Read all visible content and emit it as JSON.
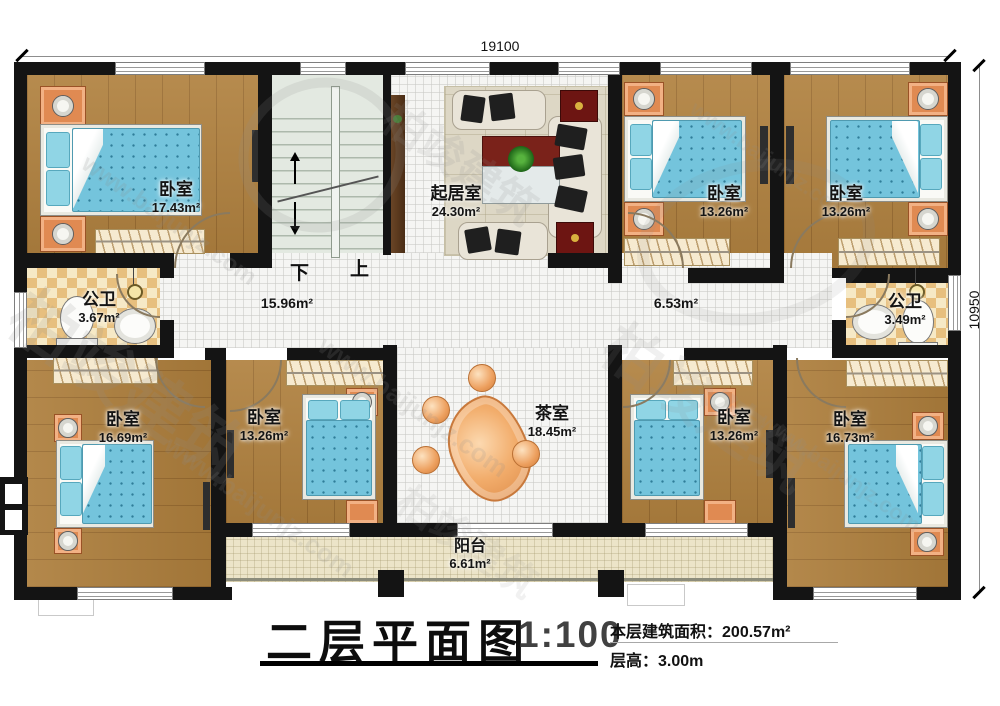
{
  "watermark": {
    "brand": "柏竣建筑",
    "site": "www.baijunjz.com"
  },
  "dimensions": {
    "top": "19100",
    "right": "10950"
  },
  "plan": {
    "stairs_down": "下",
    "stairs_up": "上",
    "hall_left_area": "15.96m²",
    "hall_right_area": "6.53m²"
  },
  "rooms": {
    "bedroom_tl": {
      "name": "卧室",
      "area": "17.43m²"
    },
    "bedroom_t2": {
      "name": "卧室",
      "area": "13.26m²"
    },
    "bedroom_t3": {
      "name": "卧室",
      "area": "13.26m²"
    },
    "living": {
      "name": "起居室",
      "area": "24.30m²"
    },
    "bath_left": {
      "name": "公卫",
      "area": "3.67m²"
    },
    "bath_right": {
      "name": "公卫",
      "area": "3.49m²"
    },
    "bedroom_bl": {
      "name": "卧室",
      "area": "16.69m²"
    },
    "bedroom_b2": {
      "name": "卧室",
      "area": "13.26m²"
    },
    "bedroom_b3": {
      "name": "卧室",
      "area": "13.26m²"
    },
    "bedroom_br": {
      "name": "卧室",
      "area": "16.73m²"
    },
    "tea": {
      "name": "茶室",
      "area": "18.45m²"
    },
    "balcony": {
      "name": "阳台",
      "area": "6.61m²"
    }
  },
  "title_block": {
    "title": "二层平面图",
    "scale": "1:100",
    "floor_area_label": "本层建筑面积：",
    "floor_area_value": "200.57m²",
    "floor_height_label": "层高：",
    "floor_height_value": "3.00m"
  }
}
